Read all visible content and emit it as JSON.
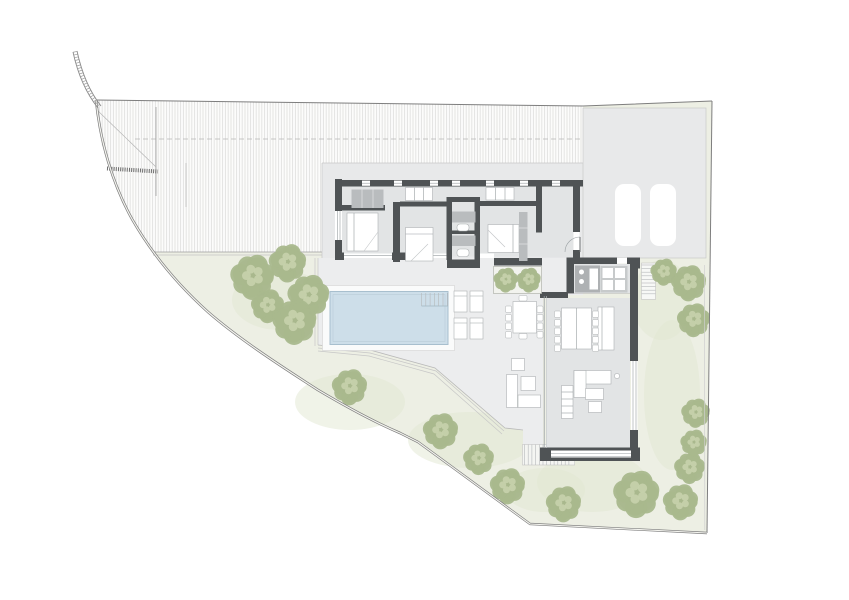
{
  "palette": {
    "background": "#ffffff",
    "garden": "#edefe4",
    "garden_patch": "#e2e8d2",
    "slope_fill": "#fcfcfb",
    "slope_hatch_line": "#cfcfcf",
    "plate": "#e8e9ea",
    "terrace": "#ecedee",
    "indoor_floor": "#e2e4e5",
    "wall": "#4f5355",
    "glazing_line": "#989ea1",
    "furniture_line": "#aeb1b3",
    "cabinet_gray": "#b9bcbe",
    "appliance_gray": "#c7cacb",
    "counter_gray": "#aeb1b3",
    "pool_water": "#cddee9",
    "pool_edge": "#a8bfce",
    "pool_deck": "#fafbfb",
    "tree_base": "#a9b88d",
    "tree_light": "#c7d2ac",
    "tree_dark": "#97a87c",
    "boundary_line": "#7e7e7e",
    "boundary_inner": "#cfcfcf",
    "stair_tread": "#b5b8ba"
  },
  "scene": {
    "site_outline": "M96,100 L583,106 L712,101 L707,533 L530,524 L418,442 L400,433 C372,421 345,406 318,390 C276,363 238,338 208,312 C178,285 152,254 132,219 C112,183 100,140 96,100 Z",
    "slope_outline": "M96,100 L583,106 L583,163 L322,163 L322,252 L153,252 C133,220 113,184 101,142 Z",
    "garden_patches": [
      {
        "cx": 280,
        "cy": 300,
        "rx": 48,
        "ry": 30
      },
      {
        "cx": 350,
        "cy": 402,
        "rx": 55,
        "ry": 28
      },
      {
        "cx": 470,
        "cy": 440,
        "rx": 62,
        "ry": 28
      },
      {
        "cx": 592,
        "cy": 482,
        "rx": 55,
        "ry": 30
      },
      {
        "cx": 672,
        "cy": 395,
        "rx": 28,
        "ry": 75
      },
      {
        "cx": 662,
        "cy": 300,
        "rx": 30,
        "ry": 40
      },
      {
        "cx": 545,
        "cy": 490,
        "rx": 40,
        "ry": 22
      }
    ],
    "trees": [
      {
        "x": 253,
        "y": 277,
        "r": 20
      },
      {
        "x": 288,
        "y": 263,
        "r": 17
      },
      {
        "x": 309,
        "y": 296,
        "r": 19
      },
      {
        "x": 268,
        "y": 306,
        "r": 15
      },
      {
        "x": 295,
        "y": 322,
        "r": 20
      },
      {
        "x": 350,
        "y": 387,
        "r": 16
      },
      {
        "x": 441,
        "y": 431,
        "r": 16
      },
      {
        "x": 479,
        "y": 459,
        "r": 14
      },
      {
        "x": 508,
        "y": 486,
        "r": 16
      },
      {
        "x": 564,
        "y": 504,
        "r": 16
      },
      {
        "x": 637,
        "y": 494,
        "r": 21
      },
      {
        "x": 681,
        "y": 502,
        "r": 16
      },
      {
        "x": 690,
        "y": 468,
        "r": 14
      },
      {
        "x": 689,
        "y": 283,
        "r": 16
      },
      {
        "x": 664,
        "y": 272,
        "r": 12
      },
      {
        "x": 694,
        "y": 320,
        "r": 15
      },
      {
        "x": 696,
        "y": 413,
        "r": 13
      },
      {
        "x": 694,
        "y": 443,
        "r": 12
      }
    ],
    "planter": {
      "x": 493.5,
      "y": 266.5,
      "w": 48,
      "h": 27
    },
    "planter_trees": [
      {
        "x": 506,
        "y": 280,
        "r": 11
      },
      {
        "x": 529,
        "y": 280,
        "r": 11
      }
    ],
    "parking_spots": [
      {
        "x": 615,
        "y": 184,
        "w": 26,
        "h": 62,
        "rx": 9
      },
      {
        "x": 650,
        "y": 184,
        "w": 26,
        "h": 62,
        "rx": 9
      }
    ],
    "loungers": [
      {
        "x": 454,
        "y": 291,
        "w": 13,
        "h": 21
      },
      {
        "x": 470,
        "y": 291,
        "w": 13,
        "h": 21
      },
      {
        "x": 454,
        "y": 318,
        "w": 13,
        "h": 21
      },
      {
        "x": 470,
        "y": 318,
        "w": 13,
        "h": 21
      }
    ],
    "stairs": [
      {
        "name": "interior-stair",
        "dir": "h",
        "x": 542.5,
        "y": 193,
        "w": 28.5,
        "count": 11,
        "step": 3.55,
        "rail": true,
        "bg": "none"
      },
      {
        "name": "entry-side-stair",
        "dir": "h",
        "x": 641.5,
        "y": 265,
        "w": 14,
        "count": 9,
        "step": 3.6,
        "rail": false,
        "bg": "#f7f8f6"
      },
      {
        "name": "garden-stair-south",
        "dir": "v",
        "x": 524.5,
        "y": 444.5,
        "h": 20.5,
        "count": 13,
        "step": 3.7,
        "rail": false,
        "bg": "#f4f5f2"
      },
      {
        "name": "pool-steps",
        "dir": "v",
        "x": 421.5,
        "y": 293,
        "h": 13,
        "count": 7,
        "step": 4.3,
        "rail": false,
        "bg": "none"
      }
    ],
    "dining_chairs": {
      "w": 6,
      "h": 6.5,
      "indoor_left_x": 554.5,
      "indoor_right_x": 592.5,
      "indoor_ys": [
        311,
        319.5,
        328,
        336.5,
        345
      ],
      "outdoor_left_x": 505.5,
      "outdoor_right_x": 537,
      "outdoor_ys": [
        306,
        314.5,
        323,
        331.5
      ],
      "outdoor_end_chairs": [
        {
          "x": 519,
          "y": 295.5
        },
        {
          "x": 519,
          "y": 333.5
        }
      ]
    },
    "pool": {
      "x": 330,
      "y": 291.5,
      "w": 118,
      "h": 53
    }
  }
}
